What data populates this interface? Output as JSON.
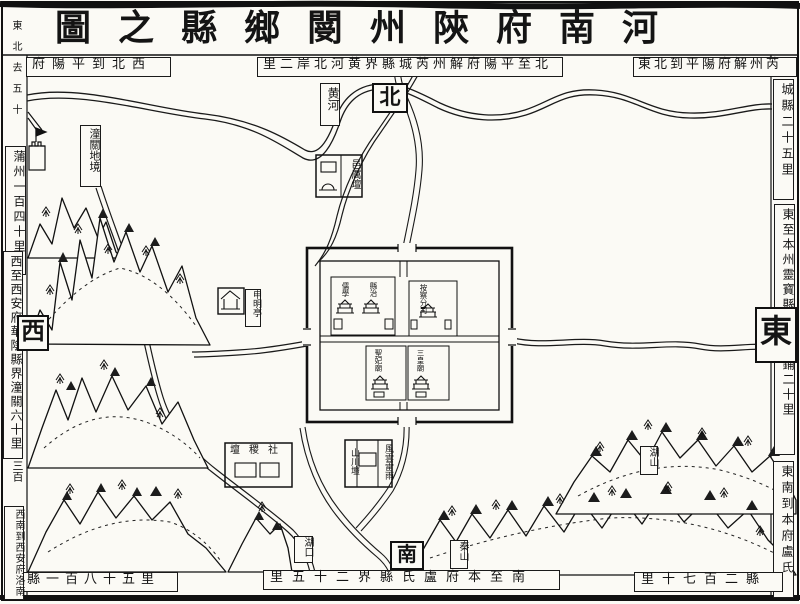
{
  "page": {
    "title": "河南府陝州閿鄉縣之圖"
  },
  "compass": {
    "north": "北",
    "south": "南",
    "east": "東",
    "west": "西"
  },
  "border_notes": {
    "top_left_corner": "東北去五十",
    "nw": "西北到平陽府",
    "left_upper": "蒲州一百四十里",
    "north": "北至平陽府解州芮城縣界黄河北岸二里",
    "ne": "東北到平陽府解州芮",
    "right_upper": "城縣二十五里",
    "east": "東至本州靈寶縣界東王鋪二十里",
    "right_lower": "東南到本府盧氏",
    "se": "縣二百七十里",
    "south": "南至本府盧氏縣界二十五里",
    "sw": "縣一百八十五里",
    "left_lower": "西南到西安府洛南",
    "west": "西至西安府華陰縣界潼關六十里",
    "left_note": "三百"
  },
  "features": {
    "yellow_river": "黄河",
    "tongguan_area": "潼關地境",
    "yi_li_altar": "邑厲壇",
    "shenming_pavilion": "申明亭",
    "sheji_altar": "社稷壇",
    "shanchuan_altar": "山川壇",
    "fengyunleiyu": "風雲雷雨",
    "hukou": "湖口",
    "qin_mountain": "秦山",
    "hu_mountain": "湖山"
  },
  "city": {
    "confucian_school": "儒學",
    "county_yamen": "縣治",
    "surveillance_branch": "按察分司",
    "shengfei_temple": "聖妃廟",
    "sanhuang_temple": "三皇廟"
  }
}
